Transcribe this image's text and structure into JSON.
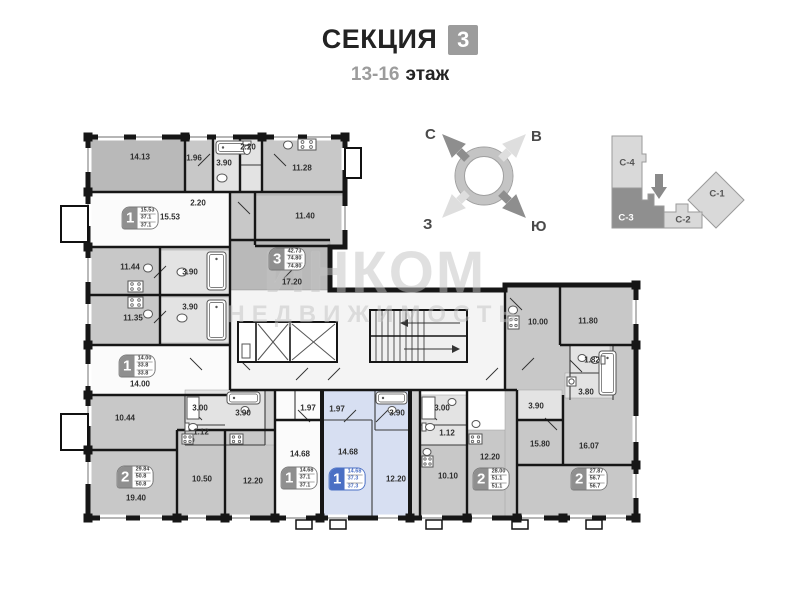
{
  "header": {
    "section_label": "СЕКЦИЯ",
    "section_number": "3",
    "floors": "13-16",
    "floors_suffix": "этаж"
  },
  "compass": {
    "north": "С",
    "east": "В",
    "south": "Ю",
    "west": "З"
  },
  "minimap": {
    "sections": [
      {
        "id": "С-4",
        "active": false
      },
      {
        "id": "С-3",
        "active": true
      },
      {
        "id": "С-2",
        "active": false
      },
      {
        "id": "С-1",
        "active": false
      }
    ]
  },
  "watermark": {
    "line1": "ИНКОМ",
    "line2": "НЕДВИЖИМОСТЬ"
  },
  "colors": {
    "room_gray": "#c8c8c8",
    "room_dark_gray": "#b9b9b9",
    "room_light": "#e3e3e3",
    "highlight_blue": "#d7dff2",
    "highlight_border": "#4a6fc4",
    "badge_gray": "#8f8f8f",
    "minimap_active": "#8f8f8f",
    "minimap_inactive": "#d9d9d9",
    "watermark_gray": "#c3c3c3",
    "wall_black": "#161616"
  },
  "plan": {
    "rooms": [
      {
        "label": "14.13",
        "x": 140,
        "y": 157
      },
      {
        "label": "1.96",
        "x": 194,
        "y": 158
      },
      {
        "label": "3.90",
        "x": 224,
        "y": 163
      },
      {
        "label": "2.20",
        "x": 248,
        "y": 147
      },
      {
        "label": "11.28",
        "x": 302,
        "y": 168
      },
      {
        "label": "15.53",
        "x": 170,
        "y": 217
      },
      {
        "label": "2.20",
        "x": 198,
        "y": 203
      },
      {
        "label": "11.40",
        "x": 305,
        "y": 216
      },
      {
        "label": "11.44",
        "x": 130,
        "y": 267
      },
      {
        "label": "3.90",
        "x": 190,
        "y": 272
      },
      {
        "label": "17.20",
        "x": 292,
        "y": 282
      },
      {
        "label": "11.35",
        "x": 133,
        "y": 318
      },
      {
        "label": "3.90",
        "x": 190,
        "y": 307
      },
      {
        "label": "14.00",
        "x": 140,
        "y": 384
      },
      {
        "label": "10.00",
        "x": 538,
        "y": 322
      },
      {
        "label": "11.80",
        "x": 588,
        "y": 321
      },
      {
        "label": "1.82",
        "x": 592,
        "y": 360
      },
      {
        "label": "3.80",
        "x": 586,
        "y": 392
      },
      {
        "label": "10.44",
        "x": 125,
        "y": 418
      },
      {
        "label": "3.00",
        "x": 200,
        "y": 408
      },
      {
        "label": "3.90",
        "x": 243,
        "y": 413
      },
      {
        "label": "1.12",
        "x": 201,
        "y": 432
      },
      {
        "label": "1.97",
        "x": 308,
        "y": 408
      },
      {
        "label": "1.97",
        "x": 337,
        "y": 409
      },
      {
        "label": "3.90",
        "x": 397,
        "y": 413
      },
      {
        "label": "3.00",
        "x": 442,
        "y": 408
      },
      {
        "label": "1.12",
        "x": 447,
        "y": 433
      },
      {
        "label": "3.90",
        "x": 536,
        "y": 406
      },
      {
        "label": "14.68",
        "x": 300,
        "y": 454
      },
      {
        "label": "14.68",
        "x": 348,
        "y": 452
      },
      {
        "label": "12.20",
        "x": 396,
        "y": 479
      },
      {
        "label": "10.50",
        "x": 202,
        "y": 479
      },
      {
        "label": "12.20",
        "x": 253,
        "y": 481
      },
      {
        "label": "19.40",
        "x": 136,
        "y": 498
      },
      {
        "label": "10.10",
        "x": 448,
        "y": 476
      },
      {
        "label": "12.20",
        "x": 490,
        "y": 457
      },
      {
        "label": "15.80",
        "x": 540,
        "y": 444
      },
      {
        "label": "16.07",
        "x": 589,
        "y": 446
      }
    ],
    "units": [
      {
        "num": "1",
        "lines": [
          "15.53",
          "37.1",
          "37.1"
        ],
        "x": 140,
        "y": 218,
        "highlighted": false
      },
      {
        "num": "3",
        "lines": [
          "42.73",
          "74.80",
          "74.80"
        ],
        "x": 287,
        "y": 259,
        "highlighted": false
      },
      {
        "num": "1",
        "lines": [
          "14.00",
          "33.8",
          "33.8"
        ],
        "x": 137,
        "y": 366,
        "highlighted": false
      },
      {
        "num": "2",
        "lines": [
          "29.84",
          "50.8",
          "50.8"
        ],
        "x": 135,
        "y": 477,
        "highlighted": false
      },
      {
        "num": "1",
        "lines": [
          "14.68",
          "37.1",
          "37.1"
        ],
        "x": 299,
        "y": 478,
        "highlighted": false
      },
      {
        "num": "1",
        "lines": [
          "14.68",
          "37.3",
          "37.3"
        ],
        "x": 347,
        "y": 479,
        "highlighted": true
      },
      {
        "num": "2",
        "lines": [
          "28.00",
          "51.1",
          "51.1"
        ],
        "x": 491,
        "y": 479,
        "highlighted": false
      },
      {
        "num": "2",
        "lines": [
          "27.87",
          "56.7",
          "56.7"
        ],
        "x": 589,
        "y": 479,
        "highlighted": false
      }
    ]
  }
}
